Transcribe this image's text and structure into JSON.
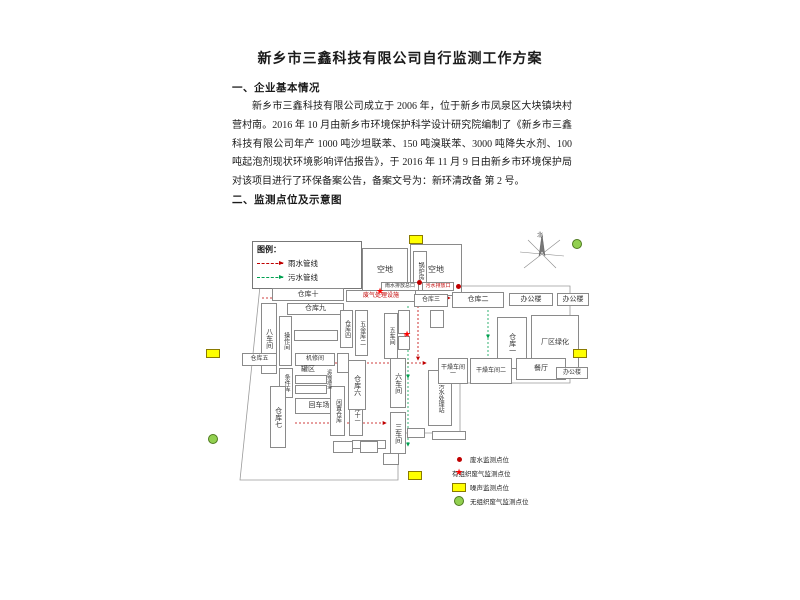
{
  "document": {
    "title": "新乡市三鑫科技有限公司自行监测工作方案",
    "section1_heading": "一、企业基本情况",
    "section1_paragraph": "新乡市三鑫科技有限公司成立于 2006 年，位于新乡市凤泉区大块镇块村营村南。2016 年 10 月由新乡市环境保护科学设计研究院编制了《新乡市三鑫科技有限公司年产 1000 吨沙坦联苯、150 吨溴联苯、3000 吨降失水剂、100 吨起泡剂现状环境影响评估报告》，于 2016 年 11 月 9 日由新乡市环境保护局对该项目进行了环保备案公告，备案文号为：新环清改备 第 2 号。",
    "section2_heading": "二、监测点位及示意图"
  },
  "diagram": {
    "compass_label": "北",
    "legend_top": {
      "title": "图例：",
      "items": [
        {
          "label": "雨水管线",
          "color": "#c00000"
        },
        {
          "label": "污水管线",
          "color": "#00a050"
        }
      ]
    },
    "legend_bottom": {
      "items": [
        {
          "symbol": "water-dot",
          "label": "废水监测点位",
          "color": "#c00000"
        },
        {
          "symbol": "red-star",
          "label": "有组织废气监测点位",
          "color": "#ff0000"
        },
        {
          "symbol": "yellow-rect",
          "label": "噪声监测点位",
          "color": "#ffff00"
        },
        {
          "symbol": "green-circle",
          "label": "无组织废气监测点位",
          "color": "#92d050"
        }
      ]
    },
    "boundary": "60,68 370,68 370,165 260,165 260,215 198,215 198,262 40,262 60,68",
    "boxes": [
      {
        "id": "open-lot-a",
        "label": "空地",
        "x": 162,
        "y": 30,
        "w": 46,
        "h": 44,
        "fs": 8
      },
      {
        "id": "open-lot-b",
        "label": "空地",
        "x": 210,
        "y": 26,
        "w": 52,
        "h": 52,
        "fs": 8
      },
      {
        "id": "boiler-room",
        "label": "锅炉房",
        "x": 213,
        "y": 33,
        "w": 14,
        "h": 40,
        "v": true,
        "fs": 6
      },
      {
        "id": "warehouse-10",
        "label": "仓库十",
        "x": 72,
        "y": 70,
        "w": 72,
        "h": 13
      },
      {
        "id": "waste-gas-facility-top",
        "label": "废气处理设施",
        "x": 146,
        "y": 72,
        "w": 70,
        "h": 12,
        "red": true,
        "fs": 6
      },
      {
        "id": "rain-outlet-label",
        "label": "雨水排放总口",
        "x": 181,
        "y": 64,
        "w": 38,
        "h": 9,
        "fs": 5
      },
      {
        "id": "sewage-outlet-label",
        "label": "污水排放口",
        "x": 222,
        "y": 64,
        "w": 32,
        "h": 9,
        "fs": 5,
        "red": true
      },
      {
        "id": "warehouse-9",
        "label": "仓库九",
        "x": 87,
        "y": 85,
        "w": 57,
        "h": 12
      },
      {
        "id": "workshop-8",
        "label": "八车间",
        "x": 61,
        "y": 85,
        "w": 16,
        "h": 71,
        "v": true
      },
      {
        "id": "operation-room",
        "label": "操作间",
        "x": 79,
        "y": 98,
        "w": 13,
        "h": 50,
        "v": true,
        "fs": 6
      },
      {
        "id": "small-room-1",
        "label": "",
        "x": 94,
        "y": 112,
        "w": 44,
        "h": 11
      },
      {
        "id": "warehouse-5",
        "label": "仓库五",
        "x": 42,
        "y": 135,
        "w": 35,
        "h": 13,
        "fs": 6
      },
      {
        "id": "spare-store",
        "label": "条件库",
        "x": 79,
        "y": 150,
        "w": 14,
        "h": 30,
        "v": true,
        "fs": 6
      },
      {
        "id": "machine-repair-room",
        "label": "机修间",
        "x": 95,
        "y": 135,
        "w": 40,
        "h": 13,
        "fs": 6
      },
      {
        "id": "small-room-2",
        "label": "",
        "x": 137,
        "y": 135,
        "w": 12,
        "h": 20
      },
      {
        "id": "tank-area-label",
        "label": "罐区",
        "x": 95,
        "y": 147,
        "w": 26,
        "h": 9,
        "noborder": true,
        "fs": 7
      },
      {
        "id": "tank-box-1",
        "label": "",
        "x": 95,
        "y": 157,
        "w": 32,
        "h": 9
      },
      {
        "id": "tank-box-2",
        "label": "",
        "x": 95,
        "y": 167,
        "w": 32,
        "h": 9
      },
      {
        "id": "warehouse-7",
        "label": "仓库七",
        "x": 70,
        "y": 168,
        "w": 16,
        "h": 62,
        "v": true
      },
      {
        "id": "turnaround-area",
        "label": "回车场",
        "x": 95,
        "y": 180,
        "w": 48,
        "h": 16
      },
      {
        "id": "idle-warehouse",
        "label": "闲置仓库",
        "x": 130,
        "y": 168,
        "w": 15,
        "h": 50,
        "v": true,
        "fs": 6
      },
      {
        "id": "warehouse-11",
        "label": "仓库十一",
        "x": 149,
        "y": 170,
        "w": 14,
        "h": 48,
        "v": true,
        "fs": 6
      },
      {
        "id": "small-room-3",
        "label": "",
        "x": 152,
        "y": 222,
        "w": 34,
        "h": 9
      },
      {
        "id": "transport-passage",
        "label": "运输通道",
        "x": 124,
        "y": 138,
        "w": 9,
        "h": 46,
        "v": true,
        "fs": 5,
        "noborder": true
      },
      {
        "id": "warehouse-6",
        "label": "仓库六",
        "x": 148,
        "y": 142,
        "w": 18,
        "h": 50,
        "v": true
      },
      {
        "id": "warehouse-4",
        "label": "仓库四",
        "x": 140,
        "y": 92,
        "w": 13,
        "h": 38,
        "v": true,
        "fs": 6
      },
      {
        "id": "hardware-store-2",
        "label": "五金库二",
        "x": 155,
        "y": 92,
        "w": 13,
        "h": 46,
        "v": true,
        "fs": 6
      },
      {
        "id": "waste-gas-facility-mid",
        "label": "废气处理设施",
        "x": 200,
        "y": 90,
        "w": 10,
        "h": 52,
        "v": true,
        "red": true,
        "fs": 5,
        "noborder": true
      },
      {
        "id": "workshop-5",
        "label": "五车间",
        "x": 184,
        "y": 95,
        "w": 14,
        "h": 46,
        "v": true,
        "fs": 6
      },
      {
        "id": "workshop-6",
        "label": "六车间",
        "x": 190,
        "y": 140,
        "w": 16,
        "h": 50,
        "v": true
      },
      {
        "id": "workshop-3",
        "label": "三车间",
        "x": 190,
        "y": 194,
        "w": 16,
        "h": 42,
        "v": true
      },
      {
        "id": "sewage-treatment-station",
        "label": "污水处理站",
        "x": 228,
        "y": 152,
        "w": 24,
        "h": 56,
        "v": true,
        "fs": 6
      },
      {
        "id": "warehouse-3",
        "label": "仓库三",
        "x": 214,
        "y": 76,
        "w": 34,
        "h": 13,
        "fs": 6
      },
      {
        "id": "warehouse-2",
        "label": "仓库二",
        "x": 252,
        "y": 74,
        "w": 52,
        "h": 16
      },
      {
        "id": "office-building-1",
        "label": "办公楼",
        "x": 309,
        "y": 75,
        "w": 44,
        "h": 13
      },
      {
        "id": "office-building-2",
        "label": "办公楼",
        "x": 357,
        "y": 75,
        "w": 32,
        "h": 13
      },
      {
        "id": "warehouse-1",
        "label": "仓库一",
        "x": 297,
        "y": 99,
        "w": 30,
        "h": 52,
        "v": true
      },
      {
        "id": "plant-greening",
        "label": "厂区绿化",
        "x": 331,
        "y": 97,
        "w": 48,
        "h": 56
      },
      {
        "id": "drying-workshop-1",
        "label": "干燥车间一",
        "x": 238,
        "y": 140,
        "w": 30,
        "h": 26,
        "fs": 6
      },
      {
        "id": "drying-workshop-2",
        "label": "干燥车间二",
        "x": 270,
        "y": 140,
        "w": 42,
        "h": 26,
        "fs": 6
      },
      {
        "id": "canteen",
        "label": "餐厅",
        "x": 316,
        "y": 140,
        "w": 50,
        "h": 22
      },
      {
        "id": "office-building-3",
        "label": "办公楼",
        "x": 356,
        "y": 149,
        "w": 32,
        "h": 12,
        "fs": 6
      },
      {
        "id": "small-room-4",
        "label": "",
        "x": 198,
        "y": 92,
        "w": 12,
        "h": 24
      },
      {
        "id": "small-room-5",
        "label": "",
        "x": 198,
        "y": 118,
        "w": 12,
        "h": 14
      },
      {
        "id": "small-room-6",
        "label": "",
        "x": 230,
        "y": 92,
        "w": 14,
        "h": 18
      },
      {
        "id": "small-room-7",
        "label": "",
        "x": 207,
        "y": 210,
        "w": 18,
        "h": 10
      },
      {
        "id": "small-room-8",
        "label": "",
        "x": 232,
        "y": 213,
        "w": 34,
        "h": 9
      },
      {
        "id": "small-room-9",
        "label": "",
        "x": 133,
        "y": 223,
        "w": 20,
        "h": 12
      },
      {
        "id": "small-room-10",
        "label": "",
        "x": 160,
        "y": 223,
        "w": 18,
        "h": 12
      },
      {
        "id": "small-room-11",
        "label": "",
        "x": 183,
        "y": 235,
        "w": 16,
        "h": 12
      }
    ],
    "markers": [
      {
        "type": "noise",
        "x": 209,
        "y": 17
      },
      {
        "type": "noise",
        "x": 6,
        "y": 131
      },
      {
        "type": "noise",
        "x": 373,
        "y": 131
      },
      {
        "type": "noise",
        "x": 208,
        "y": 253
      },
      {
        "type": "gas",
        "x": 372,
        "y": 21
      },
      {
        "type": "gas",
        "x": 8,
        "y": 216
      },
      {
        "type": "water",
        "x": 217,
        "y": 62
      },
      {
        "type": "water",
        "x": 256,
        "y": 66
      },
      {
        "type": "stack",
        "x": 176,
        "y": 69
      },
      {
        "type": "stack",
        "x": 203,
        "y": 112
      }
    ],
    "pipelines": [
      {
        "color": "red",
        "points": "62,80 150,80 250,80"
      },
      {
        "color": "red",
        "points": "218,84 218,142"
      },
      {
        "color": "red",
        "points": "95,145 160,145 226,145"
      },
      {
        "color": "red",
        "points": "95,205 140,205 186,205"
      },
      {
        "color": "green",
        "points": "208,88 208,160 208,228"
      },
      {
        "color": "green",
        "points": "288,88 288,120 288,150"
      }
    ]
  }
}
